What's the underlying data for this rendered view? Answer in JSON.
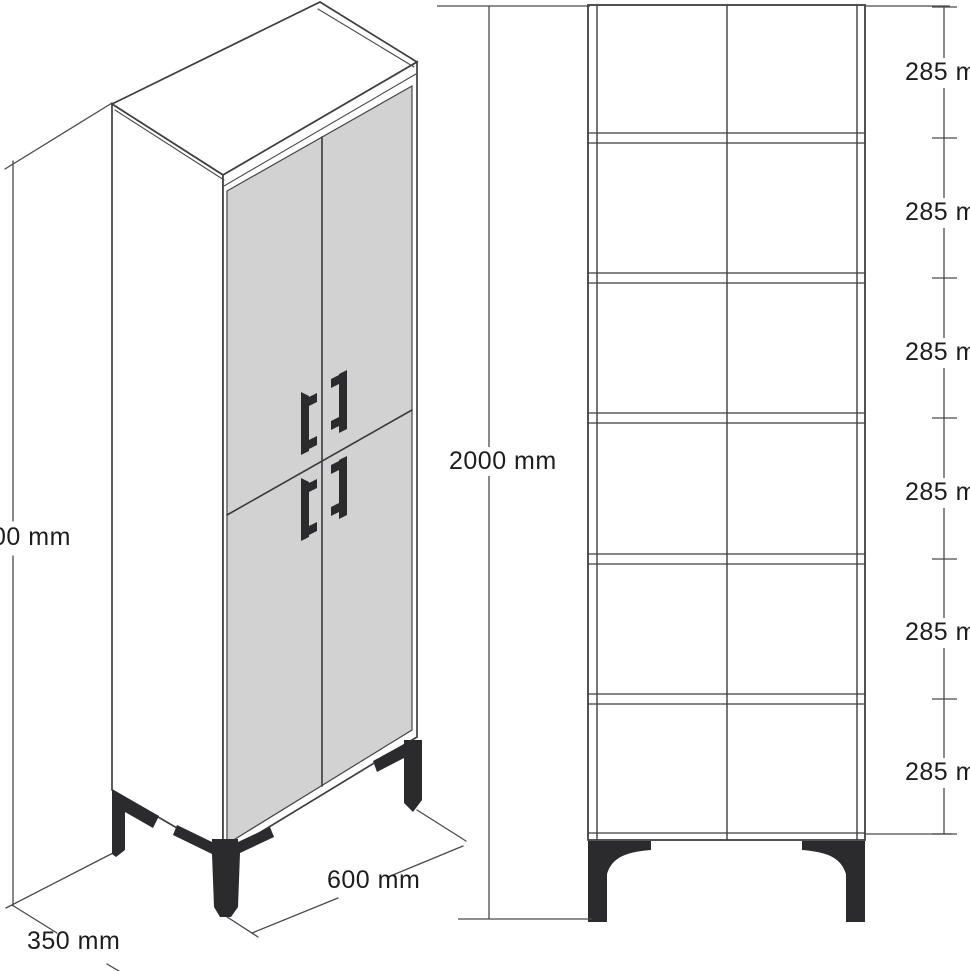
{
  "drawing": {
    "kind": "furniture-technical-drawing",
    "subject": "tall four-door cabinet with legs, isometric view and front section view",
    "units": "mm",
    "views": {
      "isometric": {
        "labels": {
          "height": "00 mm",
          "depth": "350 mm",
          "width": "600 mm"
        }
      },
      "front": {
        "labels": {
          "height": "2000 mm",
          "compartments": [
            "285 mm",
            "285 mm",
            "285 mm",
            "285 mm",
            "285 mm",
            "285 mm"
          ]
        },
        "compartment_count": 6
      }
    },
    "colors": {
      "background": "#ffffff",
      "line": "#3f3f3f",
      "door_gray": "#d2d2d2",
      "hardware_black": "#2b2b2d",
      "text": "#1d1d1d"
    }
  }
}
